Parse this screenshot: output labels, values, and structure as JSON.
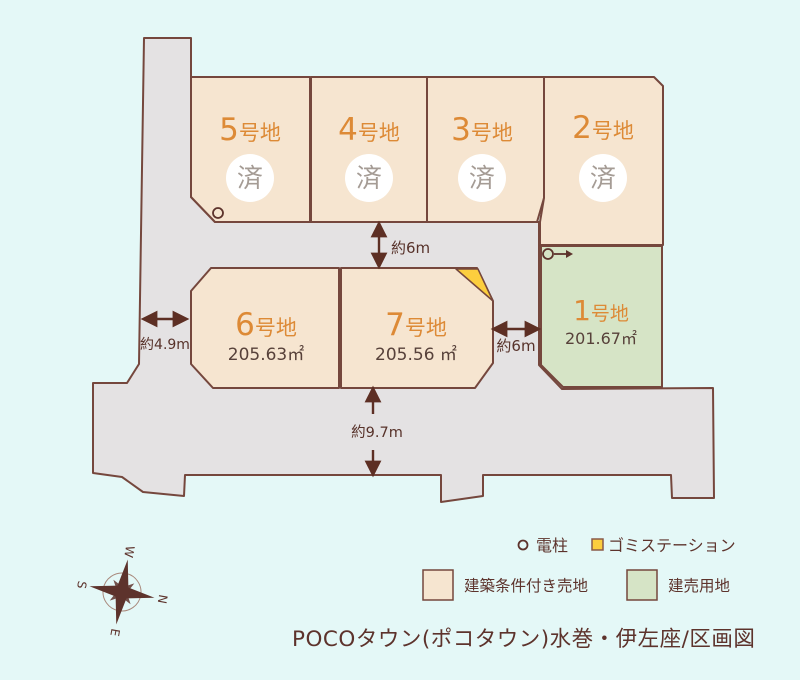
{
  "title": "POCOタウン(ポコタウン)水巻・伊左座/区画図",
  "plots": {
    "p5": {
      "num": "5",
      "suffix": "号地",
      "status": "済"
    },
    "p4": {
      "num": "4",
      "suffix": "号地",
      "status": "済"
    },
    "p3": {
      "num": "3",
      "suffix": "号地",
      "status": "済"
    },
    "p2": {
      "num": "2",
      "suffix": "号地",
      "status": "済"
    },
    "p6": {
      "num": "6",
      "suffix": "号地",
      "area": "205.63㎡"
    },
    "p7": {
      "num": "7",
      "suffix": "号地",
      "area": "205.56 ㎡"
    },
    "p1": {
      "num": "1",
      "suffix": "号地",
      "area": "201.67㎡"
    }
  },
  "dimensions": {
    "road_top": "約6m",
    "road_left": "約4.9m",
    "road_right": "約6m",
    "road_bottom": "約9.7m"
  },
  "legend": {
    "pole_label": "電柱",
    "garbage_label": "ゴミステーション",
    "conditional_label": "建築条件付き売地",
    "sale_label": "建売用地"
  },
  "compass": {
    "n": "N",
    "e": "E",
    "s": "S",
    "w": "W"
  },
  "colors": {
    "background": "#e4f8f7",
    "road": "#e4e2e3",
    "plot_beige": "#f6e5d0",
    "plot_green": "#d6e4c6",
    "garbage_yellow": "#fcce3e",
    "outline": "#75473d",
    "label_orange": "#dd8a36",
    "text_brown": "#5d332c",
    "sold_gray": "#a59c95"
  }
}
